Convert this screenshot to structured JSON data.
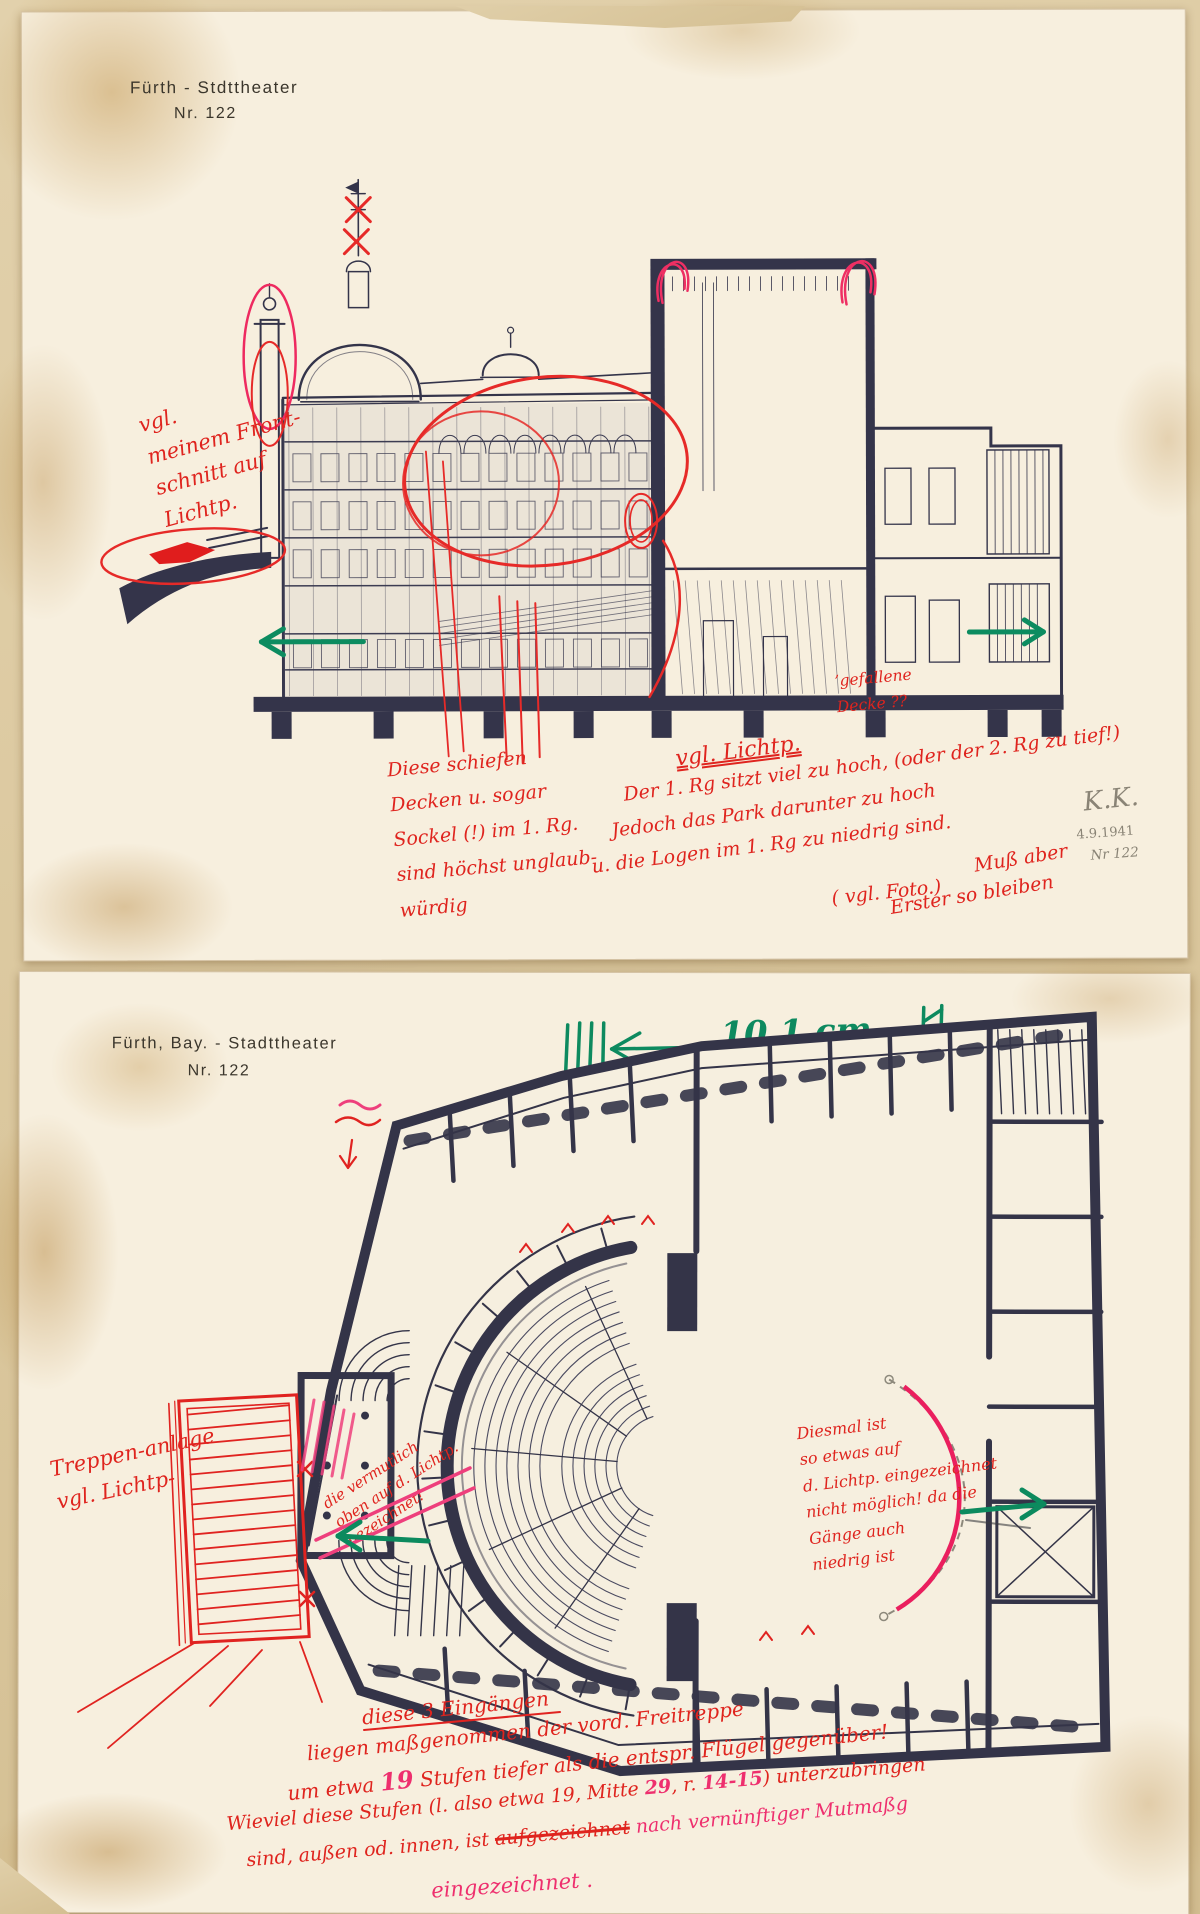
{
  "colors": {
    "red_ink": "#df241e",
    "pink_ink": "#ee2f6e",
    "green_marker": "#0d8a5f",
    "drawing_ink": "#34344a",
    "pencil": "#8a8476",
    "paper": "#f7efde"
  },
  "sheet1": {
    "title": {
      "line1": "Fürth - Stdttheater",
      "line2": "Nr. 122"
    },
    "notes": {
      "front_note": "vgl.\nmeinem Front-\nschnitt auf\nLichtp.",
      "ceiling_note": "Diese schiefen\nDecken u. sogar\nSockel (!) im 1. Rg.\nsind höchst unglaub-\nwürdig",
      "lichtp_heading": "vgl. Lichtp.",
      "rank_line1": "Der 1. Rg sitzt viel zu hoch, (oder der 2. Rg zu tief!)",
      "rank_line2": "Jedoch das Park darunter zu hoch",
      "rank_line3": "u. die Logen im 1. Rg zu niedrig sind.",
      "foto_note": "( vgl. Foto.)",
      "muss_note": "Muß aber",
      "bleiben_note": "Erster so bleiben",
      "fallen_note": "’gefallene\nDecke ??"
    },
    "stamp": {
      "initials": "K.K.",
      "date": "4.9.1941",
      "number": "Nr 122"
    }
  },
  "sheet2": {
    "title": {
      "line1": "Fürth, Bay. - Stadttheater",
      "line2": "Nr. 122"
    },
    "scale": {
      "value": "10,1 cm"
    },
    "notes": {
      "stairs_note": "Treppen-anlage\nvgl. Lichtp-",
      "crossed_note": "die vermutlich\noben auf d. Lichtp.\nbezeichnet!",
      "stage_note": "Diesmal ist\nso etwas auf\nd. Lichtp. eingezeichnet\nnicht möglich! da die\nGänge auch\nniedrig ist",
      "bottom": {
        "l1": "diese 3 Eingängen",
        "l2": "liegen maßgenommen der vord. Freitreppe",
        "l3a": "um etwa ",
        "l3b": "19",
        "l3c": " Stufen tiefer als die entspr. Flügel gegenüber!",
        "l4a": "Wieviel diese Stufen (l. also etwa 19, Mitte ",
        "l4b": "29",
        "l4c": ", r. ",
        "l4d": "14-15",
        "l4e": ") unterzubringen",
        "l5a": "sind, außen od. innen, ist ",
        "l5b": "aufgezeichnet",
        "l5c": " nach vernünftiger Mutmaßg",
        "l6": "eingezeichnet ."
      }
    }
  }
}
